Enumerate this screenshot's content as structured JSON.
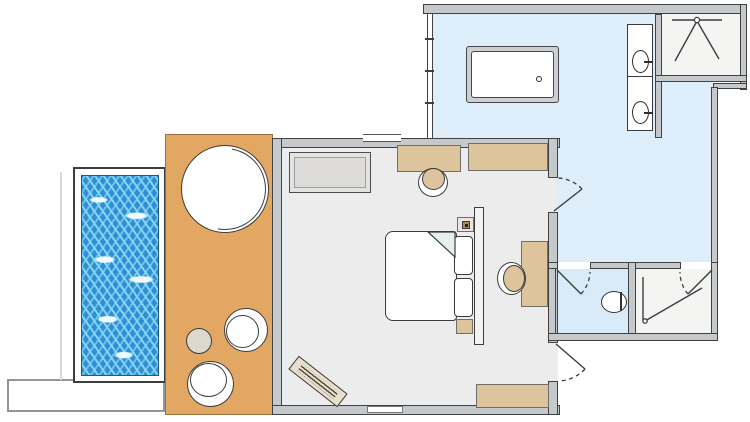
{
  "page": {
    "kind": "architectural floor plan of a hotel pool-villa room",
    "visible_text": []
  },
  "colors": {
    "background": "#ffffff",
    "wall_fill": "#c6c9cb",
    "wall_line": "#3f4143",
    "bedroom_floor": "#ececec",
    "bathroom_floor": "#ddeefa",
    "wc_floor": "#d9ebf8",
    "shower_floor": "#f4f4f3",
    "deck": "#e2a863",
    "deck_edge": "#9b7340",
    "furniture_tan": "#ddc49c",
    "furniture_line": "#6e6d66",
    "sofa_fill": "#e3e3e2",
    "pool_water": "#2e8fd4",
    "pool_ripple": "#eefaff",
    "ink": "#3b3d3f"
  },
  "rooms": [
    {
      "id": "bedroom",
      "floor_color_key": "bedroom_floor"
    },
    {
      "id": "bathroom",
      "floor_color_key": "bathroom_floor"
    },
    {
      "id": "wc",
      "floor_color_key": "wc_floor"
    },
    {
      "id": "shower-top-right",
      "floor_color_key": "shower_floor"
    },
    {
      "id": "shower-bottom-right",
      "floor_color_key": "shower_floor"
    },
    {
      "id": "deck-terrace",
      "floor_color_key": "deck"
    },
    {
      "id": "plunge-pool",
      "floor_color_key": "pool_water"
    }
  ],
  "fixtures": [
    "plunge-pool",
    "walkway",
    "round-daybed",
    "deck-side-table",
    "deck-chair",
    "deck-chair",
    "sofa",
    "dressing-table",
    "dressing-chair",
    "wardrobe-console",
    "double-bed",
    "pillow",
    "pillow",
    "headboard",
    "nightstand-with-lamp",
    "nightstand",
    "desk",
    "desk-chair",
    "luggage-rack",
    "bench",
    "bathtub-with-drain",
    "double-vanity",
    "sink",
    "sink",
    "shower-symbol",
    "shower-symbol",
    "toilet",
    "bathroom-door-swing",
    "entry-door-swing",
    "wc-door-swing",
    "shower-door-swing",
    "window-glazing",
    "window-segment"
  ]
}
